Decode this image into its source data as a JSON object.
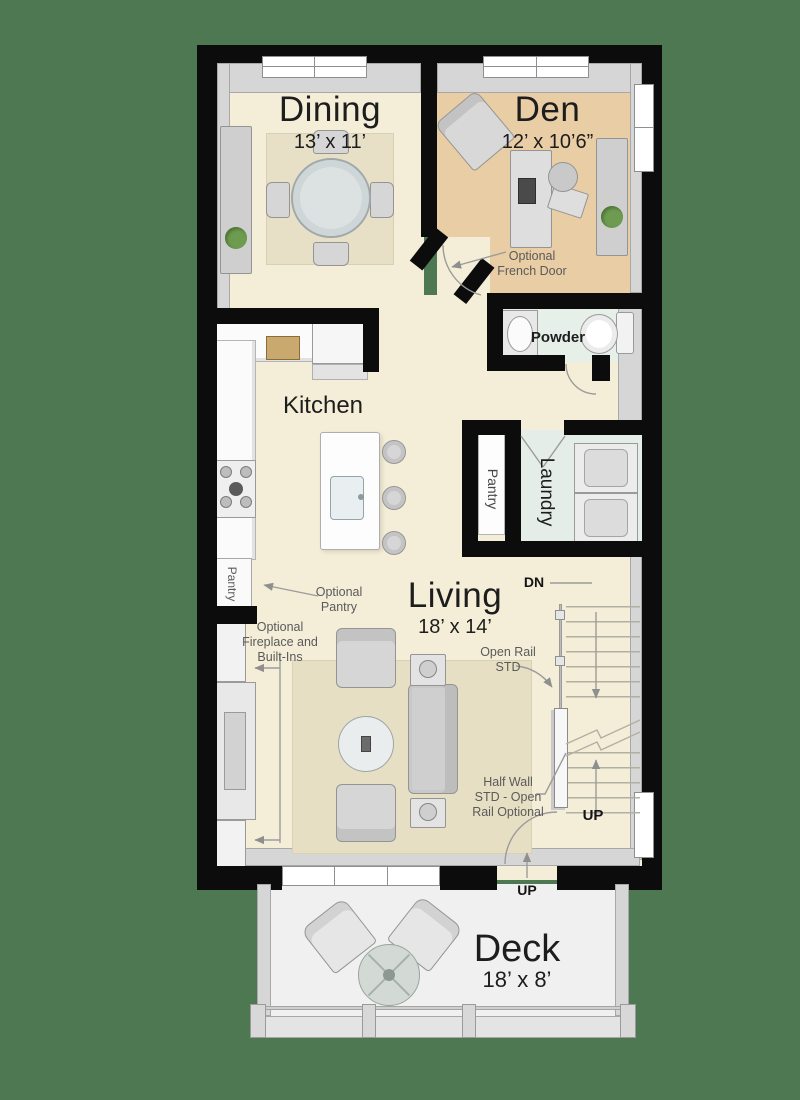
{
  "rooms": {
    "dining": {
      "name": "Dining",
      "dims": "13’ x 11’"
    },
    "den": {
      "name": "Den",
      "dims": "12’ x 10’6”"
    },
    "kitchen": {
      "name": "Kitchen"
    },
    "powder": {
      "name": "Powder"
    },
    "pantry": {
      "name": "Pantry"
    },
    "laundry": {
      "name": "Laundry"
    },
    "optional_pantry_cabinet": {
      "name": "Pantry"
    },
    "living": {
      "name": "Living",
      "dims": "18’ x 14’"
    },
    "deck": {
      "name": "Deck",
      "dims": "18’ x 8’"
    }
  },
  "annotations": {
    "optional_french_door": "Optional\nFrench Door",
    "optional_pantry": "Optional\nPantry",
    "optional_fireplace": "Optional\nFireplace and\nBuilt-Ins",
    "open_rail": "Open Rail\nSTD",
    "half_wall": "Half Wall\nSTD - Open\nRail Optional",
    "stairs_down": "DN",
    "stairs_up": "UP",
    "deck_up": "UP"
  },
  "colors": {
    "background": "#4e7851",
    "wall": "#0c0c0c",
    "floor_main": "#f4eed8",
    "floor_den": "#e9cda4",
    "floor_wet": "#e7efe9",
    "floor_deck": "#f0f0f0",
    "rug": "#e6dfc4",
    "annotation_text": "#5a5a5a",
    "room_text": "#1d1d1d"
  }
}
